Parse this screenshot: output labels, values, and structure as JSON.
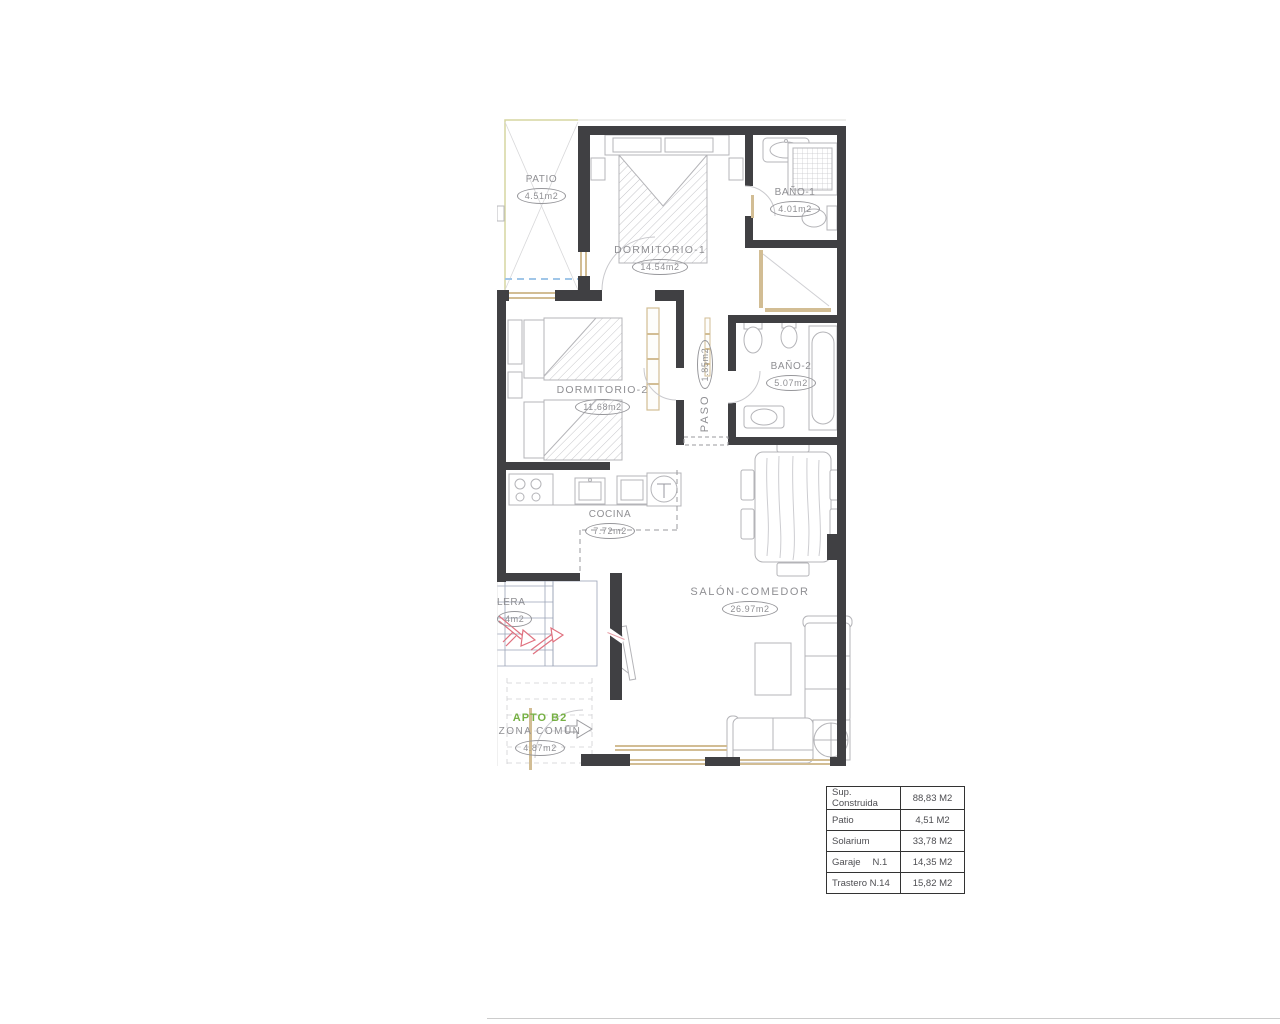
{
  "plan": {
    "apto_label": "APTO B2",
    "rooms": [
      {
        "id": "patio",
        "label": "PATIO",
        "area": "4.51m2"
      },
      {
        "id": "dormitorio-1",
        "label": "DORMITORIO-1",
        "area": "14.54m2"
      },
      {
        "id": "bano-1",
        "label": "BAÑO-1",
        "area": "4.01m2"
      },
      {
        "id": "dormitorio-2",
        "label": "DORMITORIO-2",
        "area": "11.68m2"
      },
      {
        "id": "paso",
        "label": "PASO",
        "area": "1.85m2"
      },
      {
        "id": "bano-2",
        "label": "BAÑO-2",
        "area": "5.07m2"
      },
      {
        "id": "cocina",
        "label": "COCINA",
        "area": "7.72m2"
      },
      {
        "id": "salon-comedor",
        "label": "SALÓN-COMEDOR",
        "area": "26.97m2"
      },
      {
        "id": "escalera",
        "label": "LERA",
        "area": "4m2"
      },
      {
        "id": "zona-comun",
        "label": "ZONA COMÚN",
        "area": "4.87m2"
      }
    ],
    "colors": {
      "wall": "#404043",
      "window_frame": "#d2bd94",
      "patio_line": "#d6d6a0",
      "water_dash": "#a0c6e8",
      "stair_line": "#9ba4b6",
      "stair_arrow": "#e0717f",
      "label_text": "#8f8f93",
      "apto_green": "#76b043"
    }
  },
  "summary_table": {
    "rows": [
      {
        "label": "Sup. Construida",
        "value": "88,83 M2"
      },
      {
        "label": "Patio",
        "value": "4,51 M2"
      },
      {
        "label": "Solarium",
        "value": "33,78 M2"
      },
      {
        "label": "Garaje",
        "label2": "N.1",
        "value": "14,35 M2"
      },
      {
        "label": "Trastero N.14",
        "value": "15,82 M2"
      }
    ]
  }
}
